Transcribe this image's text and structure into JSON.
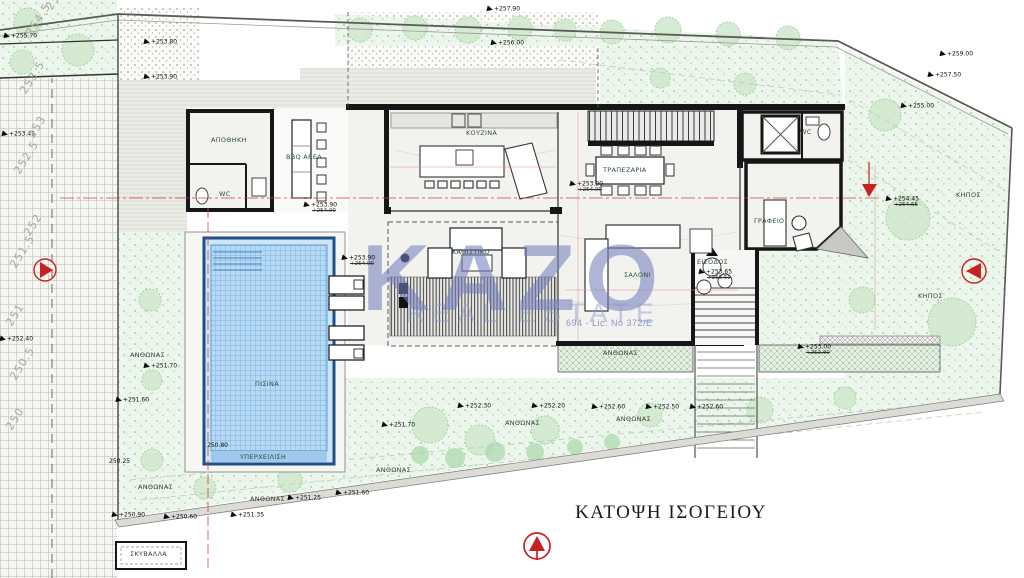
{
  "title": "ΚΑΤΟΨΗ ΙΣΟΓΕΙΟΥ",
  "watermark": {
    "brand": "KAZO",
    "tagline": "REAL ESTATE",
    "license": "694 - Lic. No 372/E"
  },
  "rooms": [
    {
      "label": "ΑΠΟΘΗΚΗ",
      "x": 211,
      "y": 137
    },
    {
      "label": "WC",
      "x": 219,
      "y": 191
    },
    {
      "label": "BBQ AREA",
      "x": 286,
      "y": 154
    },
    {
      "label": "ΚΟΥΖΙΝΑ",
      "x": 466,
      "y": 130
    },
    {
      "label": "ΤΡΑΠΕΖΑΡΙΑ",
      "x": 603,
      "y": 167
    },
    {
      "label": "WC",
      "x": 800,
      "y": 129
    },
    {
      "label": "ΓΡΑΦΕΙΟ",
      "x": 754,
      "y": 218
    },
    {
      "label": "ΚΑΘΙΣΤΙΚΟ",
      "x": 452,
      "y": 249
    },
    {
      "label": "ΣΑΛΟΝΙ",
      "x": 624,
      "y": 272
    },
    {
      "label": "ΠΙΣΙΝΑ",
      "x": 255,
      "y": 381
    },
    {
      "label": "ΥΠΕΡΧΕΙΛΙΣΗ",
      "x": 240,
      "y": 454
    },
    {
      "label": "ΕΙΣΟΔΟΣ",
      "x": 697,
      "y": 259
    }
  ],
  "outdoor_labels": [
    {
      "label": "ΑΝΘΩΝΑΣ",
      "x": 130,
      "y": 352
    },
    {
      "label": "ΑΝΘΩΝΑΣ",
      "x": 138,
      "y": 484
    },
    {
      "label": "ΑΝΘΩΝΑΣ",
      "x": 250,
      "y": 496
    },
    {
      "label": "ΑΝΘΩΝΑΣ",
      "x": 376,
      "y": 467
    },
    {
      "label": "ΑΝΘΩΝΑΣ",
      "x": 505,
      "y": 420
    },
    {
      "label": "ΑΝΘΩΝΑΣ",
      "x": 616,
      "y": 416
    },
    {
      "label": "ΑΝΘΩΝΑΣ",
      "x": 603,
      "y": 350
    },
    {
      "label": "ΚΗΠΟΣ",
      "x": 956,
      "y": 192
    },
    {
      "label": "ΚΗΠΟΣ",
      "x": 918,
      "y": 293
    },
    {
      "label": "ΣΚΥΒΑΛΛΑ",
      "x": 130,
      "y": 551
    }
  ],
  "levels": [
    {
      "v": "+255.70",
      "x": 4,
      "y": 33
    },
    {
      "v": "+253.80",
      "x": 144,
      "y": 39
    },
    {
      "v": "+253.90",
      "x": 144,
      "y": 74
    },
    {
      "v": "+253.45",
      "x": 2,
      "y": 131
    },
    {
      "v": "+257.90",
      "x": 487,
      "y": 6
    },
    {
      "v": "+256.00",
      "x": 491,
      "y": 40
    },
    {
      "v": "+259.00",
      "x": 940,
      "y": 51
    },
    {
      "v": "+257.50",
      "x": 928,
      "y": 72
    },
    {
      "v": "+255.00",
      "x": 901,
      "y": 103
    },
    {
      "v": "+254.45",
      "alt": "+254.65",
      "x": 886,
      "y": 196
    },
    {
      "v": "+253.90",
      "alt": "+254.00",
      "x": 304,
      "y": 202
    },
    {
      "v": "+253.90",
      "alt": "+254.00",
      "x": 570,
      "y": 181
    },
    {
      "v": "+253.90",
      "alt": "+254.00",
      "x": 342,
      "y": 255
    },
    {
      "v": "+253.65",
      "alt": "+253.50",
      "x": 699,
      "y": 269
    },
    {
      "v": "+253.00",
      "alt": "+252.90",
      "x": 798,
      "y": 344
    },
    {
      "v": "+251.70",
      "x": 144,
      "y": 363
    },
    {
      "v": "+251.60",
      "x": 116,
      "y": 397
    },
    {
      "v": "+252.40",
      "x": 0,
      "y": 336
    },
    {
      "v": "250.25",
      "x": 109,
      "y": 459,
      "noflag": true
    },
    {
      "v": "250.80",
      "x": 207,
      "y": 443,
      "noflag": true
    },
    {
      "v": "+251.70",
      "x": 382,
      "y": 422
    },
    {
      "v": "+252.30",
      "x": 458,
      "y": 403
    },
    {
      "v": "+252.20",
      "x": 532,
      "y": 403
    },
    {
      "v": "+252.60",
      "x": 592,
      "y": 404
    },
    {
      "v": "+252.50",
      "x": 646,
      "y": 404
    },
    {
      "v": "+252.60",
      "x": 690,
      "y": 404
    },
    {
      "v": "+251.25",
      "x": 288,
      "y": 495
    },
    {
      "v": "+251.60",
      "x": 336,
      "y": 490
    },
    {
      "v": "+250.90",
      "x": 112,
      "y": 512
    },
    {
      "v": "+250.60",
      "x": 164,
      "y": 514
    },
    {
      "v": "+251.35",
      "x": 231,
      "y": 512
    }
  ],
  "contours": [
    {
      "v": "255",
      "x": 44,
      "y": 6
    },
    {
      "v": "254.5",
      "x": 24,
      "y": 32
    },
    {
      "v": "253.5",
      "x": 18,
      "y": 90
    },
    {
      "v": "253",
      "x": 26,
      "y": 134
    },
    {
      "v": "252.5",
      "x": 12,
      "y": 170
    },
    {
      "v": "252",
      "x": 22,
      "y": 232
    },
    {
      "v": "251.5",
      "x": 8,
      "y": 264
    },
    {
      "v": "251",
      "x": 4,
      "y": 322
    },
    {
      "v": "250.5",
      "x": 8,
      "y": 376
    },
    {
      "v": "250",
      "x": 4,
      "y": 426
    }
  ],
  "icons": [
    "north-compass-icon",
    "section-marker-left-icon",
    "section-marker-right-icon",
    "slope-marker-icon",
    "entrance-arrow-icon",
    "level-flag-icon"
  ],
  "colors": {
    "wall": "#161616",
    "red_marker": "#c62222",
    "pool_water": "#b7d9f3",
    "pool_border": "#1d4f8a",
    "green_fill": "#edf6ec",
    "green_dot": "#8cc88c",
    "watermark": "#7680bc",
    "road_line": "#ccccc5"
  }
}
